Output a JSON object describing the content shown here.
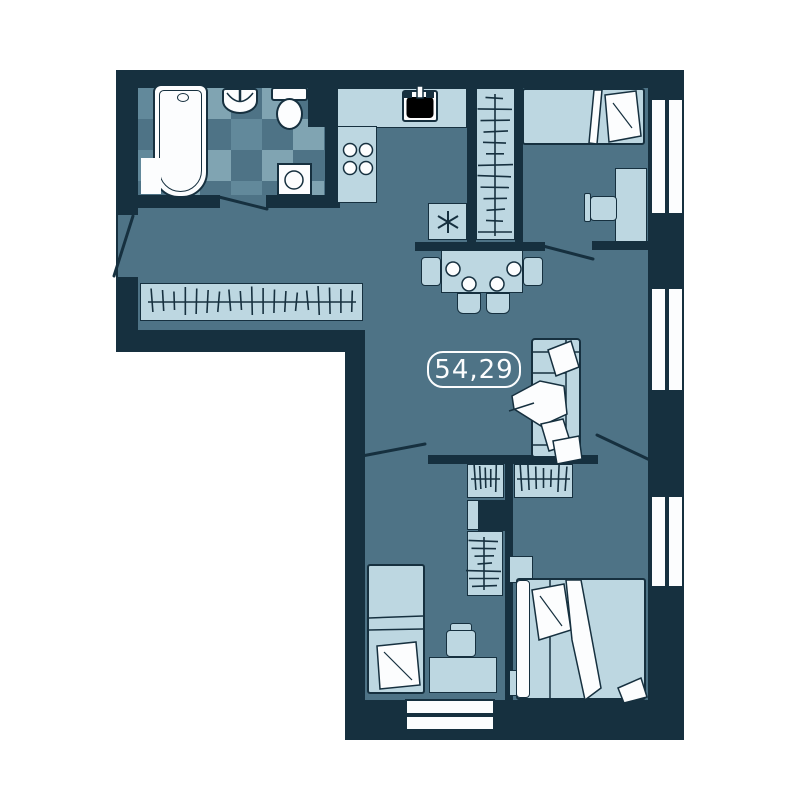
{
  "plan": {
    "area_label": "54,29"
  },
  "colors": {
    "page": "#ffffff",
    "wall": "#16303f",
    "floor": "#4e7386",
    "tile_light": "#80a4b2",
    "tile_mid": "#62899b",
    "furn": "#bdd7e1",
    "white": "#fcfdfe"
  },
  "icons": {
    "refrigerator_symbol": "asterisk-icon",
    "wardrobe_symbol": "hanger-rail-icon",
    "door_symbol": "door-swing-line-icon",
    "window_symbol": "double-pane-window-icon"
  }
}
